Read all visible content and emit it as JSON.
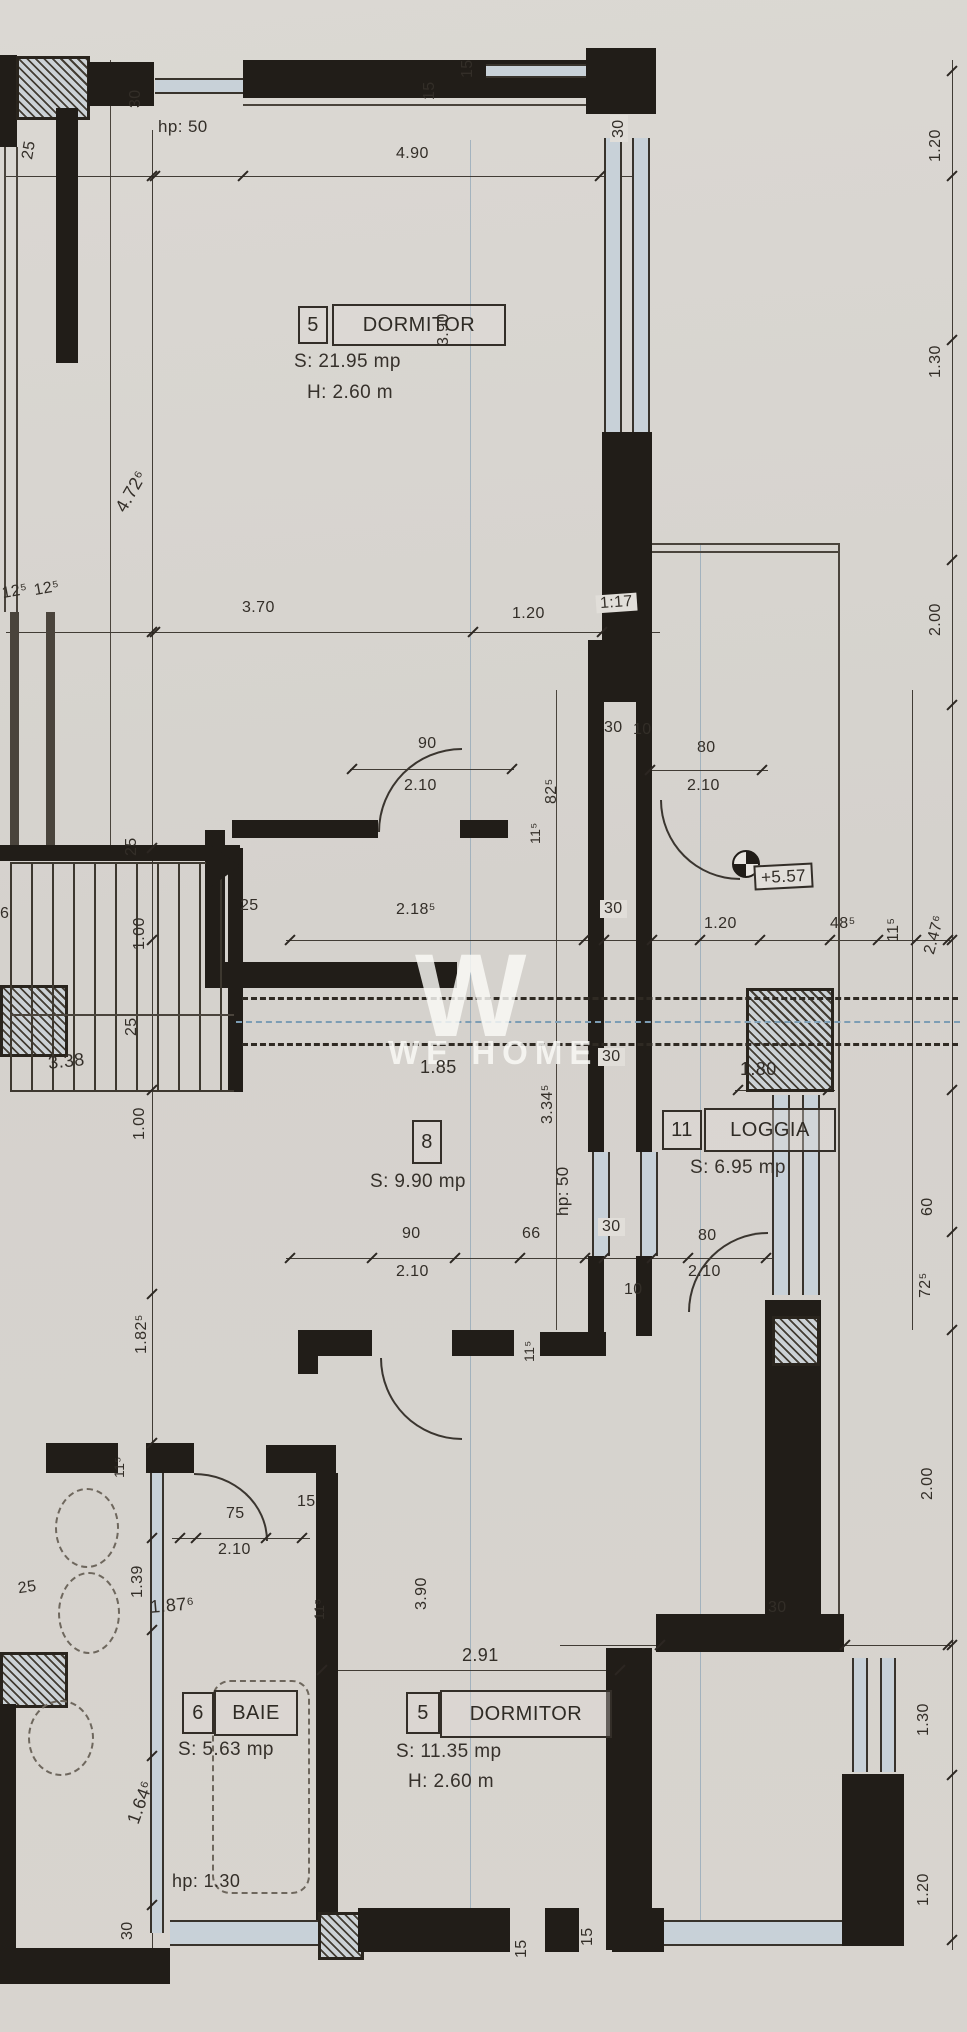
{
  "title": "Apartment floor plan (scanned)",
  "watermark": {
    "initial": "W",
    "name": "WE HOME"
  },
  "rooms": [
    {
      "number": "5",
      "name": "DORMITOR",
      "area": "S: 21.95 mp",
      "height": "H: 2.60 m"
    },
    {
      "number": "8",
      "name": "",
      "area": "S: 9.90 mp",
      "height": ""
    },
    {
      "number": "11",
      "name": "LOGGIA",
      "area": "S: 6.95 mp",
      "height": ""
    },
    {
      "number": "6",
      "name": "BAIE",
      "area": "S: 5.63 mp",
      "height": ""
    },
    {
      "number": "5",
      "name": "DORMITOR",
      "area": "S: 11.35 mp",
      "height": "H: 2.60 m"
    }
  ],
  "annotations": {
    "parapet_top": "hp: 50",
    "parapet_mid": "hp: 50",
    "parapet_baie": "hp: 1.30",
    "level_mark": "+5.57"
  },
  "dims": {
    "t25": "25",
    "t30": "30",
    "w490": "4.90",
    "t15a": "15",
    "t15b": "15",
    "t30r": "30",
    "v390a": "3.90",
    "v472": "4.72⁶",
    "v120r": "1.20",
    "v130r": "1.30",
    "v200r": "2.00",
    "l125a": "12⁵",
    "l125b": "12⁵",
    "w370": "3.70",
    "w120": "1.20",
    "w117": "1:17",
    "box30a": "30",
    "door1_w": "90",
    "door1_h": "2.10",
    "v825": "82⁵",
    "v115a": "11⁵",
    "g30": "30",
    "g10": "10",
    "door2_w": "80",
    "door2_h": "2.10",
    "s25a": "25",
    "s100a": "1.00",
    "s25b": "25",
    "s6": "6",
    "w2185": "2.18⁵",
    "box30b": "30",
    "w120b": "1.20",
    "w485": "48⁵",
    "v115b": "11⁵",
    "v2476": "2.47⁶",
    "w338": "3.38",
    "s25c": "25",
    "s100b": "1.00",
    "w185": "1.85",
    "v3345": "3.34⁵",
    "box30c": "30",
    "w180": "1.80",
    "v60": "60",
    "v725": "72⁵",
    "v200b": "2.00",
    "door3_w": "90",
    "door3_h": "2.10",
    "w66": "66",
    "box30d": "30",
    "g10b": "10",
    "door4_w": "80",
    "door4_h": "2.10",
    "v115c": "11⁵",
    "v1825": "1.82⁵",
    "v115d": "11⁵",
    "door5_w": "75",
    "door5_h": "2.10",
    "w15a": "15",
    "v139": "1.39",
    "s25d": "25",
    "w1876": "1.87⁶",
    "v115e": "11⁵",
    "w291": "2.91",
    "v390b": "3.90",
    "w30br": "30",
    "v1646": "1.64⁶",
    "v30bl": "30",
    "v15c": "15",
    "v15d": "15",
    "v130b": "1.30",
    "v120b2": "1.20"
  }
}
